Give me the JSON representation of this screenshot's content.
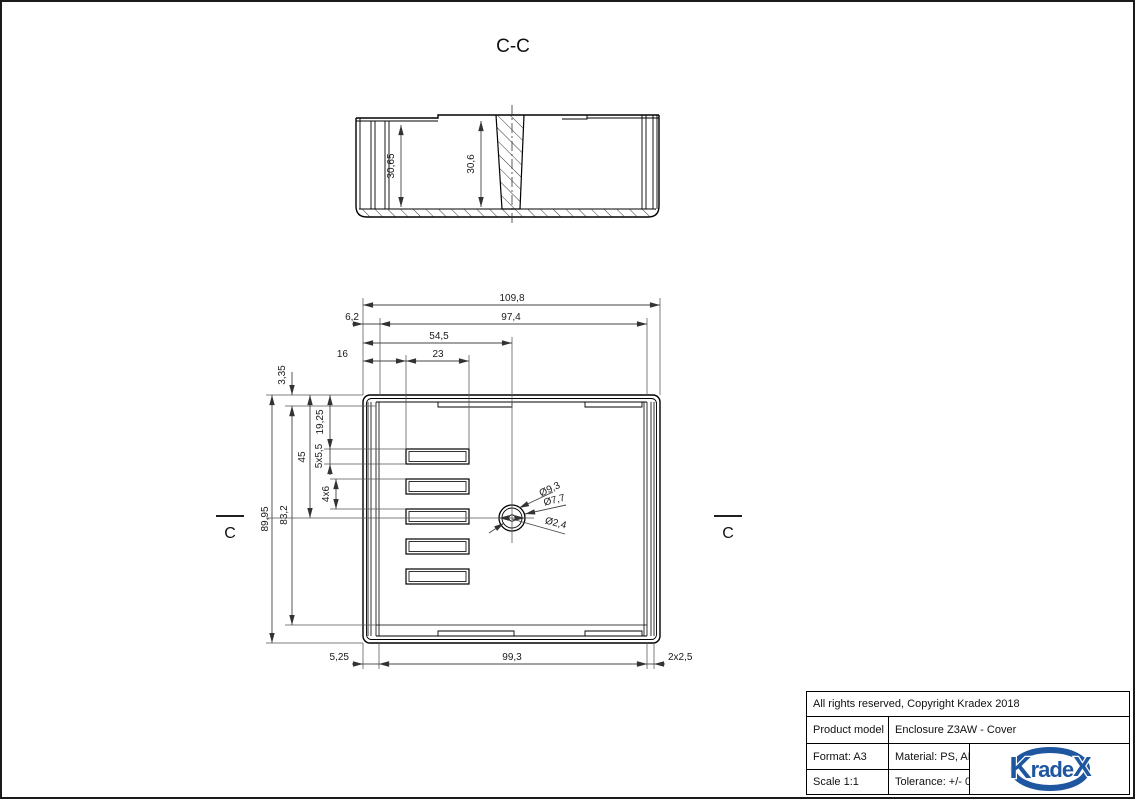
{
  "drawing": {
    "section_label": "C-C",
    "section_marker": "C",
    "section_view": {
      "depth_left": "30,65",
      "depth_right": "30,6"
    },
    "plan_view": {
      "top_dims": {
        "overall_width": "109,8",
        "left_offset": "6,2",
        "inner_width": "97,4",
        "center_offset": "54,5",
        "slot_left_offset": "16",
        "slot_width": "23"
      },
      "left_dims": {
        "top_rim": "3,35",
        "overall_height": "89,95",
        "inner_height": "83,2",
        "hole_center_offset": "45",
        "slot_top_offset": "19,25",
        "slot_height": "5x5,5",
        "slot_gap": "4x6"
      },
      "bottom_dims": {
        "wall_offset": "5,25",
        "inner_width": "99,3",
        "corner": "2x2,5"
      },
      "hole_dims": {
        "outer": "Ø9,3",
        "middle": "Ø7,7",
        "inner": "Ø2,4"
      }
    }
  },
  "title_block": {
    "copyright": "All rights reserved, Copyright Kradex 2018",
    "product_label": "Product model",
    "product_value": "Enclosure Z3AW - Cover",
    "format": "Format: A3",
    "material": "Material: PS, ABS",
    "scale": "Scale 1:1",
    "tolerance": "Tolerance: +/- 0.5"
  },
  "logo": {
    "k": "K",
    "mid": "rade",
    "x": "X"
  },
  "colors": {
    "logo_blue": "#1e56a0",
    "line": "#1a1a1a"
  }
}
